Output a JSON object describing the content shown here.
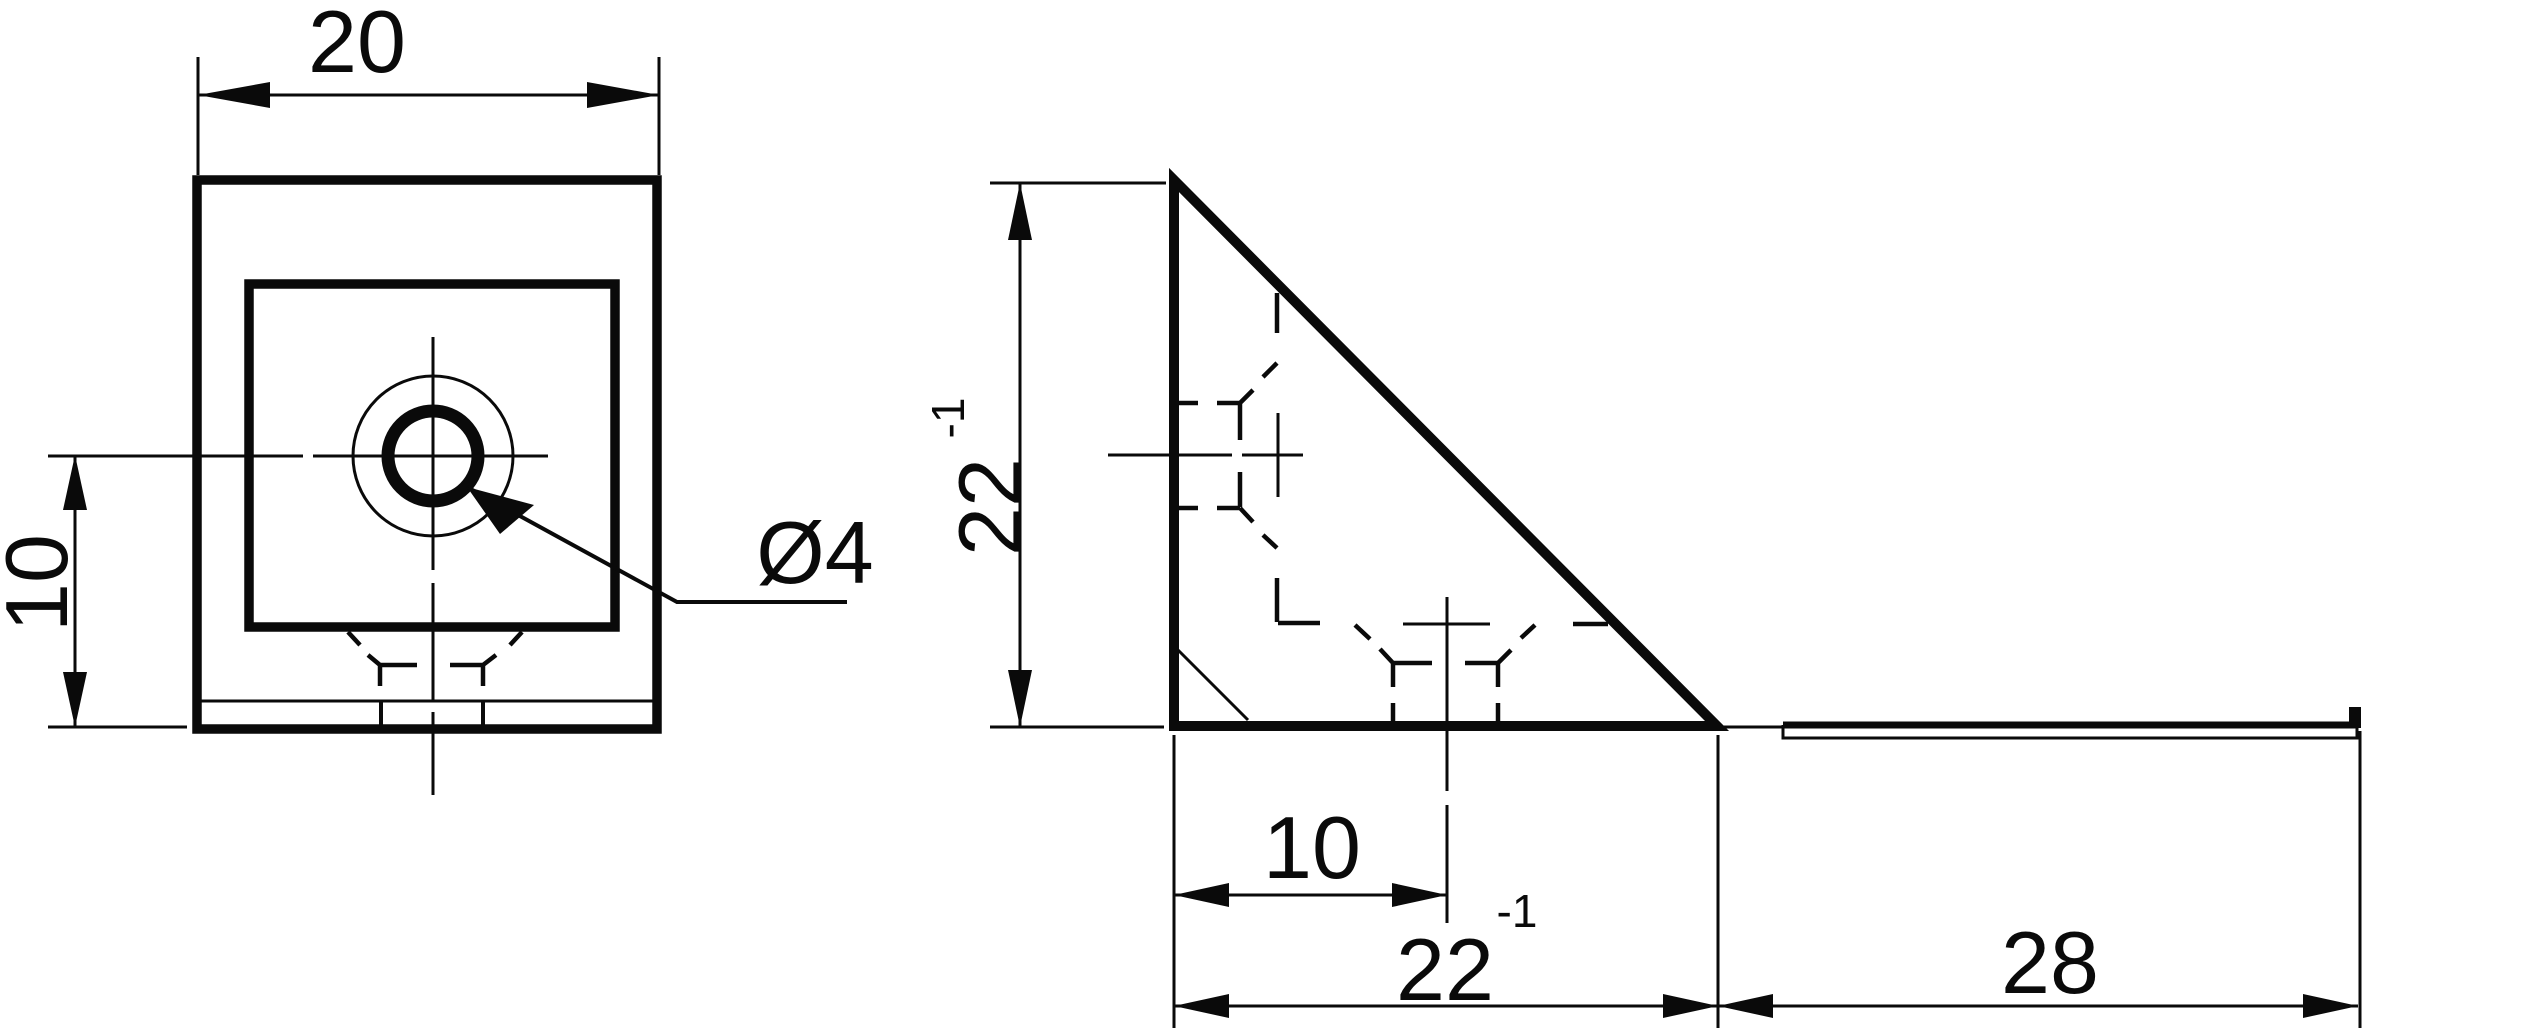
{
  "drawing": {
    "bg_color": "#ffffff",
    "ink_color": "#0a0a0a",
    "front_view": {
      "top_width_dim": "20",
      "left_height_dim": "10",
      "hole_diameter_label": "Ø4"
    },
    "side_view": {
      "height_dim_value": "22",
      "height_dim_exponent": "-1",
      "hole_offset_dim": "10",
      "base_depth_dim_value": "22",
      "base_depth_dim_exponent": "-1",
      "plate_length_dim": "28"
    }
  }
}
